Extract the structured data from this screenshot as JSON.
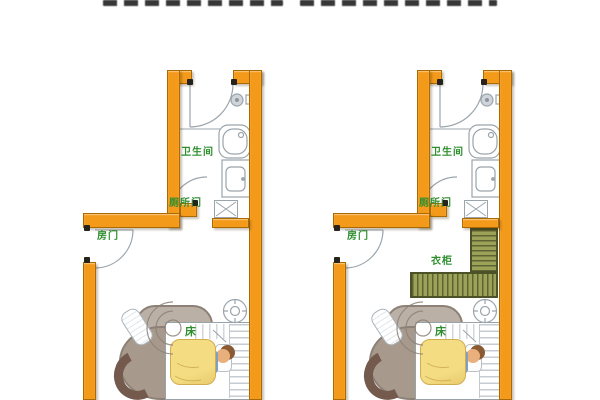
{
  "cropped_title": {
    "visible": true,
    "legible": false
  },
  "palette": {
    "title_ink": "#1c1c1c",
    "wall": "#F39A1B",
    "wall_border": "#AA6A00",
    "wall_dark_cap": "#26221d",
    "label_green": "#2F8F2F",
    "line_gray": "#9aa4ab",
    "duvet": "#F4DC82",
    "duvet_border": "#CFAE52",
    "wardrobe": "#9CA257",
    "wardrobe_stripe": "#5E6333",
    "sofa_light": "#BBB0A6",
    "sofa_mid": "#A79A8D",
    "sofa_dark": "#74594D",
    "skin": "#EAB07C",
    "hair": "#8A5A33",
    "shirt": "#7E9FC5"
  },
  "plans": [
    {
      "name": "floor-plan-left",
      "labels": {
        "bathroom": "卫生间",
        "toilet_door": "厕所门",
        "room_door": "房门",
        "bed": "床"
      }
    },
    {
      "name": "floor-plan-right",
      "labels": {
        "bathroom": "卫生间",
        "toilet_door": "厕所门",
        "room_door": "房门",
        "bed": "床",
        "wardrobe": "衣柜"
      }
    }
  ],
  "icons": [
    "door-arc",
    "bathtub",
    "sink",
    "shower-head",
    "vent-shaft",
    "ceiling-lamp",
    "bed",
    "pillow",
    "sleeping-person",
    "duvet",
    "sofa",
    "slippers",
    "wardrobe"
  ]
}
